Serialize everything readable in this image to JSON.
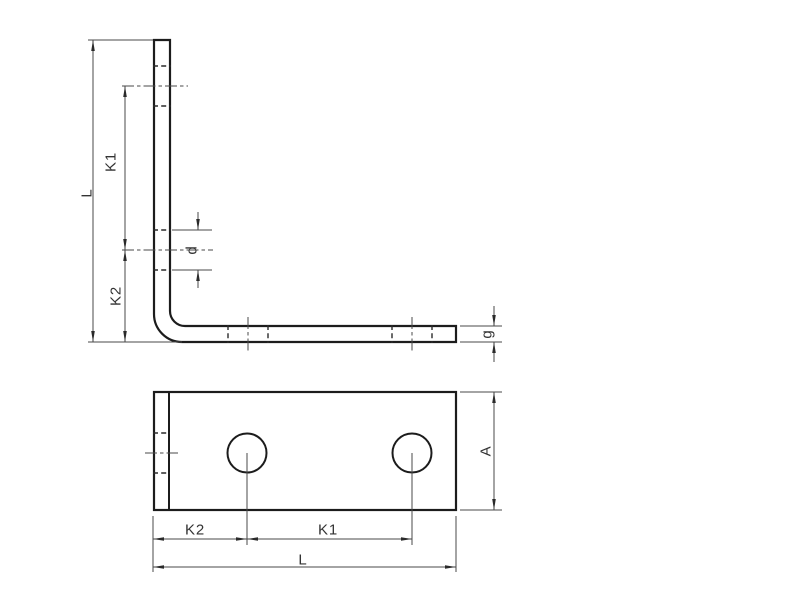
{
  "document": {
    "title": "Angle bracket technical drawing",
    "background": "#ffffff"
  },
  "colors": {
    "bg": "#ffffff",
    "outline": "#1c1c1c",
    "hidden": "#2a2a2a",
    "thin": "#4a4a4a",
    "text": "#333333"
  },
  "views": {
    "side_elevation": {
      "name": "side elevation of L-angle bracket",
      "dimensions": [
        "L",
        "K1",
        "K2",
        "d",
        "g"
      ],
      "holes_per_leg": 2
    },
    "plan_view": {
      "name": "plan view of bracket base",
      "dimensions": [
        "K2",
        "K1",
        "L",
        "A"
      ],
      "visible_holes": 2
    }
  },
  "labels": {
    "side_L": "L",
    "side_K1": "K1",
    "side_K2": "K2",
    "side_d": "d",
    "side_g": "g",
    "plan_K2": "K2",
    "plan_K1": "K1",
    "plan_L": "L",
    "plan_A": "A"
  }
}
